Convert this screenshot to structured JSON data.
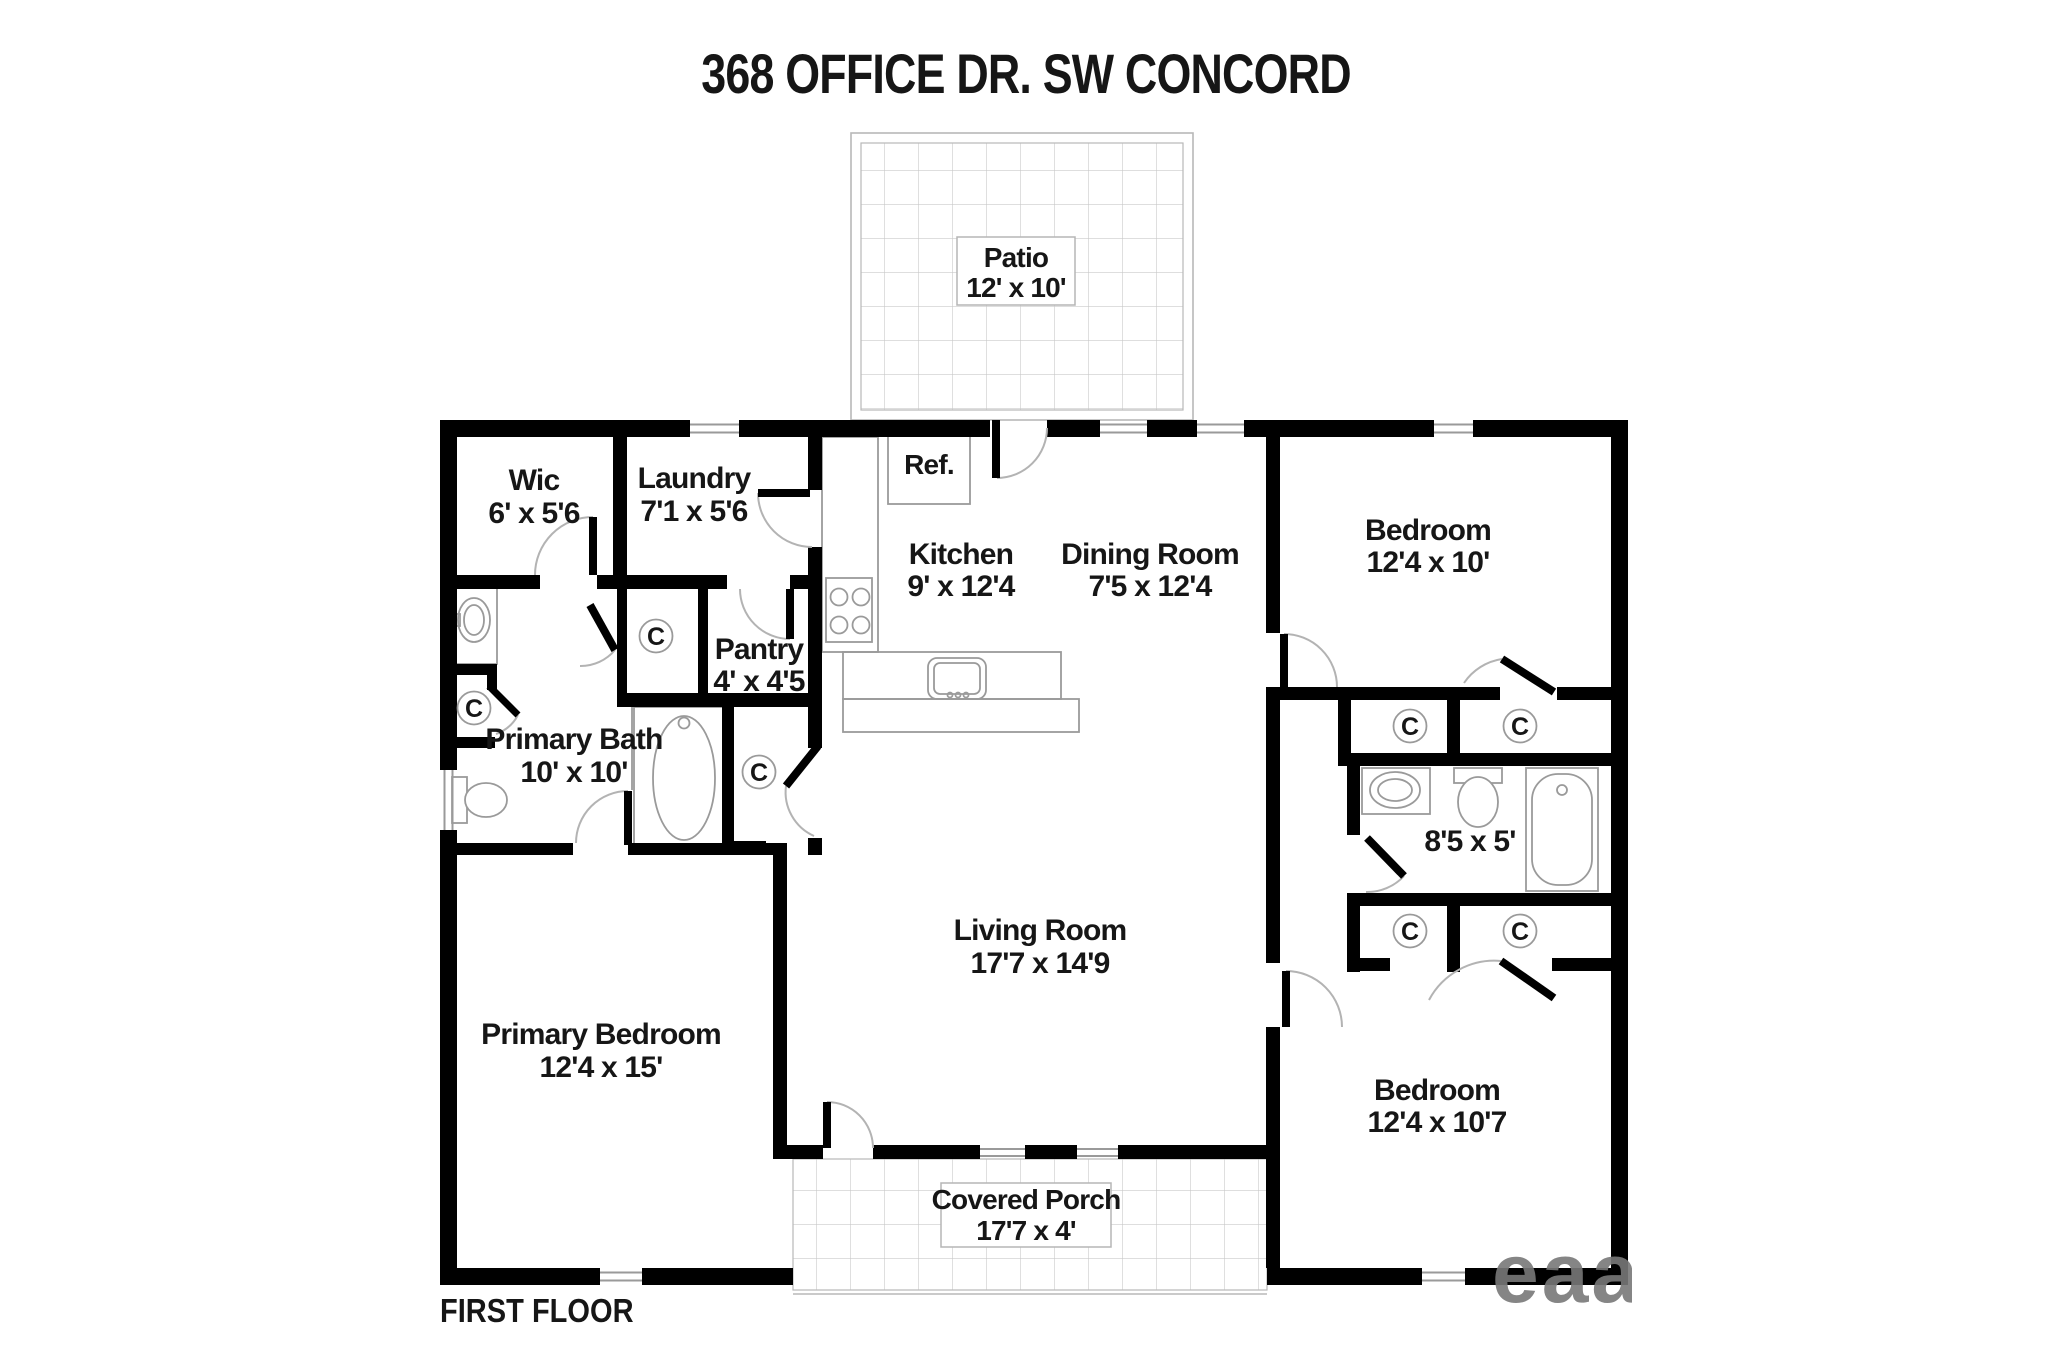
{
  "title": "368 OFFICE DR. SW CONCORD",
  "floor_label": "FIRST FLOOR",
  "watermark": "eaa",
  "colors": {
    "wall": "#000000",
    "fixture_line": "#9a9a9a",
    "tile_grid": "#c9c9c9",
    "door_arc": "#b3b3b3",
    "text": "#161616"
  },
  "outdoor": {
    "patio": {
      "name": "Patio",
      "dims": "12' x 10'"
    },
    "covered_porch": {
      "name": "Covered Porch",
      "dims": "17'7 x 4'"
    }
  },
  "rooms": {
    "wic": {
      "name": "Wic",
      "dims": "6' x 5'6"
    },
    "laundry": {
      "name": "Laundry",
      "dims": "7'1 x 5'6"
    },
    "kitchen": {
      "name": "Kitchen",
      "dims": "9' x 12'4"
    },
    "dining_room": {
      "name": "Dining Room",
      "dims": "7'5 x 12'4"
    },
    "pantry": {
      "name": "Pantry",
      "dims": "4' x 4'5"
    },
    "primary_bath": {
      "name": "Primary Bath",
      "dims": "10' x 10'"
    },
    "living_room": {
      "name": "Living Room",
      "dims": "17'7 x 14'9"
    },
    "primary_bedroom": {
      "name": "Primary Bedroom",
      "dims": "12'4 x 15'"
    },
    "bedroom_top_right": {
      "name": "Bedroom",
      "dims": "12'4 x 10'"
    },
    "bathroom_right": {
      "dims": "8'5 x 5'"
    },
    "bedroom_bottom_right": {
      "name": "Bedroom",
      "dims": "12'4 x 10'7"
    }
  },
  "labels": {
    "refrigerator": "Ref.",
    "closet": "C"
  }
}
